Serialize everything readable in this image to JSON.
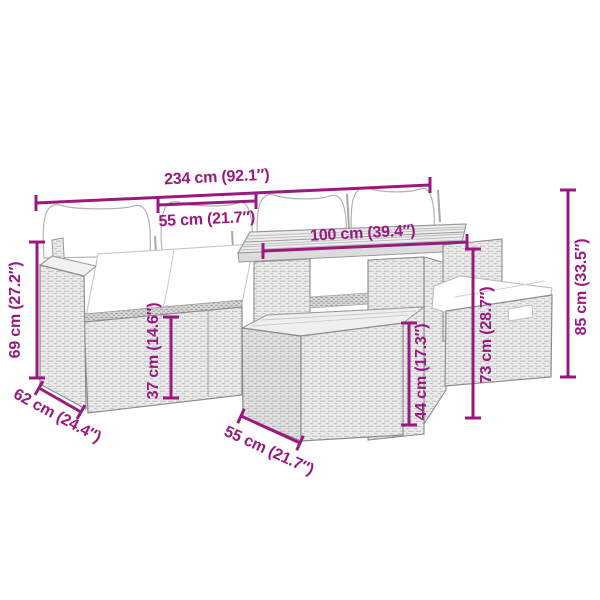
{
  "image": {
    "kind": "product dimension diagram",
    "subject": "poly rattan garden lounge set line drawing (sofa modules, dining table, two stools with cushions)",
    "background_color": "#ffffff",
    "accent_color": "#99197F",
    "drawing_fill_color": "#ebebeb",
    "drawing_outline_color": "#929292",
    "cushion_color": "#ffffff"
  },
  "dimensions": {
    "total_width": "234 cm (92.1″)",
    "module_width": "55 cm (21.7″)",
    "table_length": "100 cm (39.4″)",
    "total_height": "85 cm (33.5″)",
    "table_height": "73 cm (28.7″)",
    "stool_height": "44 cm (17.3″)",
    "seat_height": "37 cm (14.6″)",
    "arm_height": "69 cm (27.2″)",
    "seat_depth": "62 cm (24.4″)",
    "stool_width": "55 cm (21.7″)"
  }
}
